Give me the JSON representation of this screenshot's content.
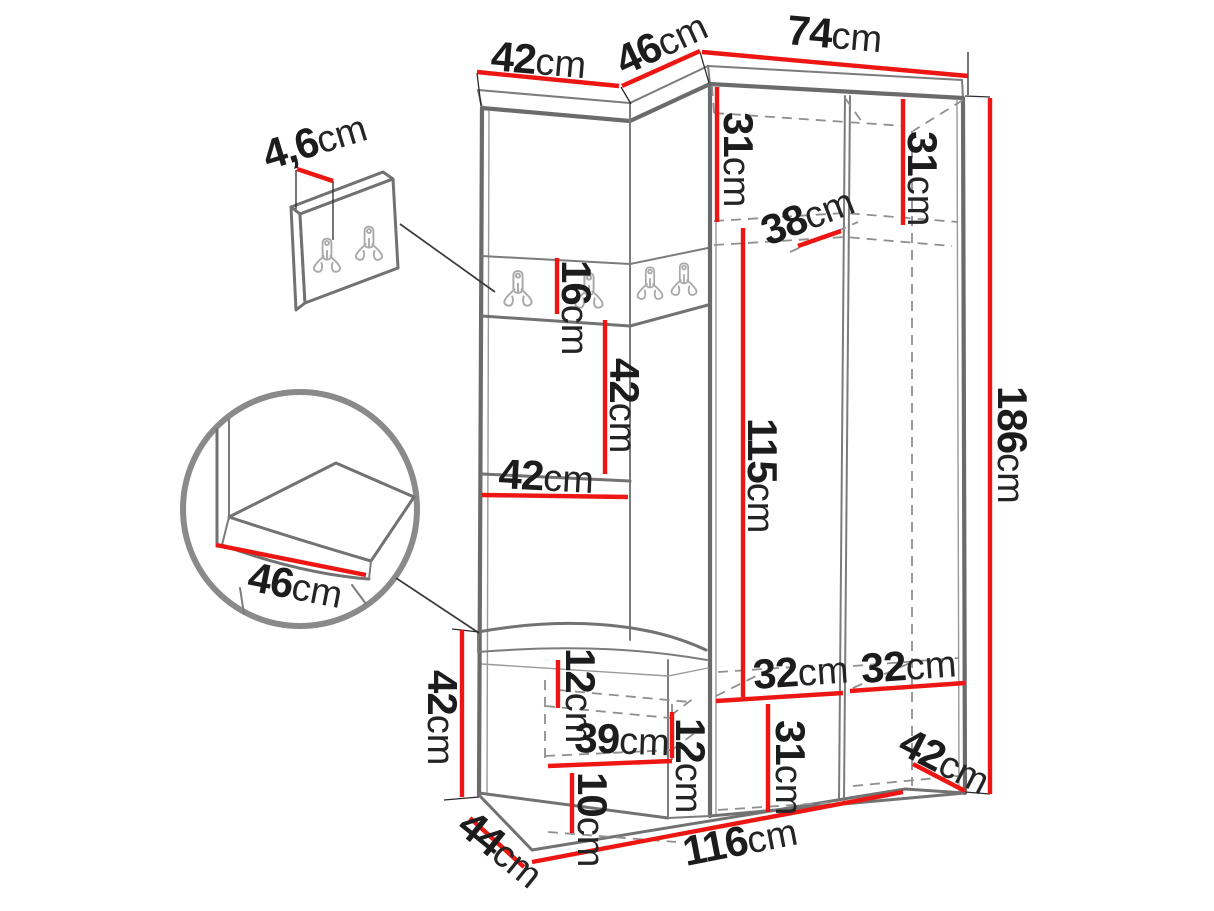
{
  "figure": {
    "kind": "furniture dimension diagram",
    "subject": "corner hallway wardrobe set with hook panels, open niche, shoe bench and separate wall-mounted hook board",
    "unit": "cm",
    "colors": {
      "dimension_line": "#ed1613",
      "outline": "#6b6b6b",
      "hidden_edge": "#8f8f8f",
      "label_text": "#1c1c1c",
      "background": "#ffffff"
    }
  },
  "dims": {
    "top_width_left": {
      "num": "42",
      "unit": "cm"
    },
    "top_width_corner": {
      "num": "46",
      "unit": "cm"
    },
    "top_width_right": {
      "num": "74",
      "unit": "cm"
    },
    "panel_thickness": {
      "num": "4,6",
      "unit": "cm"
    },
    "top_shelf_left_height": {
      "num": "31",
      "unit": "cm"
    },
    "top_shelf_right_height": {
      "num": "31",
      "unit": "cm"
    },
    "top_shelf_depth": {
      "num": "38",
      "unit": "cm"
    },
    "hook_panel_height": {
      "num": "16",
      "unit": "cm"
    },
    "niche_height": {
      "num": "42",
      "unit": "cm"
    },
    "niche_width": {
      "num": "42",
      "unit": "cm"
    },
    "hanging_space_height": {
      "num": "115",
      "unit": "cm"
    },
    "total_height": {
      "num": "186",
      "unit": "cm"
    },
    "seat_depth_detail": {
      "num": "46",
      "unit": "cm"
    },
    "bench_height": {
      "num": "42",
      "unit": "cm"
    },
    "bench_upper_gap": {
      "num": "12",
      "unit": "cm"
    },
    "bench_shelf_width": {
      "num": "39",
      "unit": "cm"
    },
    "bench_shelf_gap": {
      "num": "12",
      "unit": "cm"
    },
    "bench_lower_gap": {
      "num": "10",
      "unit": "cm"
    },
    "compartment_left_width": {
      "num": "32",
      "unit": "cm"
    },
    "compartment_right_width": {
      "num": "32",
      "unit": "cm"
    },
    "bottom_section_height": {
      "num": "31",
      "unit": "cm"
    },
    "bottom_right_depth": {
      "num": "42",
      "unit": "cm"
    },
    "bench_depth": {
      "num": "44",
      "unit": "cm"
    },
    "total_width": {
      "num": "116",
      "unit": "cm"
    }
  }
}
